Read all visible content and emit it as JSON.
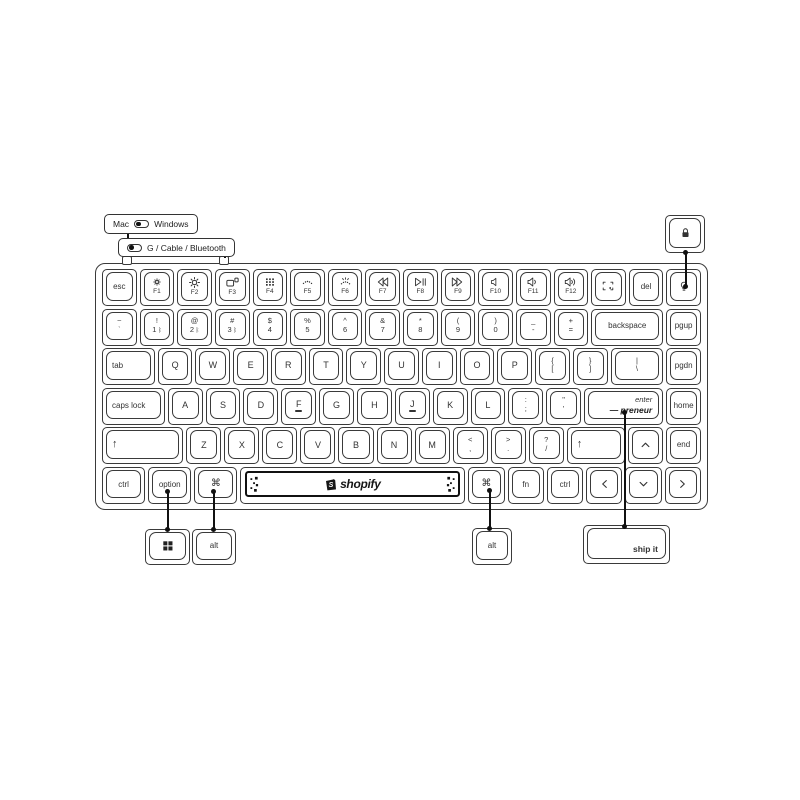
{
  "callouts": {
    "mac_windows": {
      "left_label": "Mac",
      "right_label": "Windows"
    },
    "connection": {
      "label": "G / Cable / Bluetooth"
    },
    "lock_key": {
      "icon": "lock"
    },
    "windows_key": {
      "icon": "windows-logo"
    },
    "alt_left": {
      "label": "alt"
    },
    "alt_right": {
      "label": "alt"
    },
    "ship_it": {
      "label": "ship it"
    }
  },
  "spacebar": {
    "brand": "shopify"
  },
  "colors": {
    "stroke": "#3a3a3a",
    "annotation": "#111111",
    "background": "#ffffff"
  },
  "keyboard": {
    "rows": [
      {
        "name": "function-row",
        "keys": [
          {
            "id": "esc",
            "label": "esc"
          },
          {
            "id": "f1",
            "icon": "brightness-down",
            "sub": "F1"
          },
          {
            "id": "f2",
            "icon": "brightness-up",
            "sub": "F2"
          },
          {
            "id": "f3",
            "icon": "mission-control",
            "sub": "F3"
          },
          {
            "id": "f4",
            "icon": "launchpad",
            "sub": "F4"
          },
          {
            "id": "f5",
            "icon": "backlight-down",
            "sub": "F5"
          },
          {
            "id": "f6",
            "icon": "backlight-up",
            "sub": "F6"
          },
          {
            "id": "f7",
            "icon": "rewind",
            "sub": "F7"
          },
          {
            "id": "f8",
            "icon": "play-pause",
            "sub": "F8"
          },
          {
            "id": "f9",
            "icon": "fast-forward",
            "sub": "F9"
          },
          {
            "id": "f10",
            "icon": "mute",
            "sub": "F10"
          },
          {
            "id": "f11",
            "icon": "volume-down",
            "sub": "F11"
          },
          {
            "id": "f12",
            "icon": "volume-up",
            "sub": "F12"
          },
          {
            "id": "screenshot",
            "icon": "screenshot"
          },
          {
            "id": "del",
            "label": "del"
          },
          {
            "id": "backlight",
            "icon": "lightbulb"
          }
        ]
      },
      {
        "name": "number-row",
        "keys": [
          {
            "id": "grave",
            "top": "~",
            "bottom": "`"
          },
          {
            "id": "1",
            "top": "!",
            "bottom": "1",
            "sub_icon": "bluetooth"
          },
          {
            "id": "2",
            "top": "@",
            "bottom": "2",
            "sub_icon": "bluetooth"
          },
          {
            "id": "3",
            "top": "#",
            "bottom": "3",
            "sub_icon": "bluetooth"
          },
          {
            "id": "4",
            "top": "$",
            "bottom": "4"
          },
          {
            "id": "5",
            "top": "%",
            "bottom": "5"
          },
          {
            "id": "6",
            "top": "^",
            "bottom": "6"
          },
          {
            "id": "7",
            "top": "&",
            "bottom": "7"
          },
          {
            "id": "8",
            "top": "*",
            "bottom": "8"
          },
          {
            "id": "9",
            "top": "(",
            "bottom": "9"
          },
          {
            "id": "0",
            "top": ")",
            "bottom": "0"
          },
          {
            "id": "minus",
            "top": "_",
            "bottom": "-"
          },
          {
            "id": "equals",
            "top": "+",
            "bottom": "="
          },
          {
            "id": "backspace",
            "label": "backspace",
            "w": 2.15
          },
          {
            "id": "pgup",
            "label": "pgup"
          }
        ]
      },
      {
        "name": "tab-row",
        "keys": [
          {
            "id": "tab",
            "label": "tab",
            "align": "left",
            "w": 1.55
          },
          {
            "id": "q",
            "label": "Q"
          },
          {
            "id": "w",
            "label": "W"
          },
          {
            "id": "e",
            "label": "E"
          },
          {
            "id": "r",
            "label": "R"
          },
          {
            "id": "t",
            "label": "T"
          },
          {
            "id": "y",
            "label": "Y"
          },
          {
            "id": "u",
            "label": "U"
          },
          {
            "id": "i",
            "label": "I"
          },
          {
            "id": "o",
            "label": "O"
          },
          {
            "id": "p",
            "label": "P"
          },
          {
            "id": "lbracket",
            "top": "{",
            "bottom": "["
          },
          {
            "id": "rbracket",
            "top": "}",
            "bottom": "]"
          },
          {
            "id": "backslash",
            "top": "|",
            "bottom": "\\",
            "w": 1.55
          },
          {
            "id": "pgdn",
            "label": "pgdn"
          }
        ]
      },
      {
        "name": "home-row",
        "keys": [
          {
            "id": "capslock",
            "label": "caps lock",
            "align": "left",
            "w": 1.85
          },
          {
            "id": "a",
            "label": "A"
          },
          {
            "id": "s",
            "label": "S"
          },
          {
            "id": "d",
            "label": "D"
          },
          {
            "id": "f",
            "label": "F",
            "homing": true
          },
          {
            "id": "g",
            "label": "G"
          },
          {
            "id": "h",
            "label": "H"
          },
          {
            "id": "j",
            "label": "J",
            "homing": true
          },
          {
            "id": "k",
            "label": "K"
          },
          {
            "id": "l",
            "label": "L"
          },
          {
            "id": "semicolon",
            "top": ":",
            "bottom": ";"
          },
          {
            "id": "quote",
            "top": "\"",
            "bottom": "'"
          },
          {
            "id": "enter",
            "type": "enter",
            "top": "enter",
            "bottom": "— preneur",
            "w": 2.35
          },
          {
            "id": "home",
            "label": "home"
          }
        ]
      },
      {
        "name": "shift-row",
        "keys": [
          {
            "id": "lshift",
            "label": "↑",
            "align": "left",
            "w": 2.4
          },
          {
            "id": "z",
            "label": "Z"
          },
          {
            "id": "x",
            "label": "X"
          },
          {
            "id": "c",
            "label": "C"
          },
          {
            "id": "v",
            "label": "V"
          },
          {
            "id": "b",
            "label": "B"
          },
          {
            "id": "n",
            "label": "N"
          },
          {
            "id": "m",
            "label": "M"
          },
          {
            "id": "comma",
            "top": "<",
            "bottom": ","
          },
          {
            "id": "period",
            "top": ">",
            "bottom": "."
          },
          {
            "id": "slash",
            "top": "?",
            "bottom": "/"
          },
          {
            "id": "rshift",
            "label": "↑",
            "align": "left",
            "w": 1.7
          },
          {
            "id": "up",
            "icon": "chevron-up"
          },
          {
            "id": "end",
            "label": "end"
          }
        ]
      },
      {
        "name": "bottom-row",
        "keys": [
          {
            "id": "lctrl",
            "label": "ctrl",
            "w": 1.2
          },
          {
            "id": "option",
            "label": "option",
            "w": 1.2
          },
          {
            "id": "lcmd",
            "icon": "command",
            "w": 1.2
          },
          {
            "id": "space",
            "type": "space",
            "w": 6.5
          },
          {
            "id": "rcmd",
            "icon": "command"
          },
          {
            "id": "fn",
            "label": "fn"
          },
          {
            "id": "rctrl",
            "label": "ctrl"
          },
          {
            "id": "left",
            "icon": "chevron-left"
          },
          {
            "id": "down",
            "icon": "chevron-down"
          },
          {
            "id": "right",
            "icon": "chevron-right"
          }
        ]
      }
    ]
  }
}
